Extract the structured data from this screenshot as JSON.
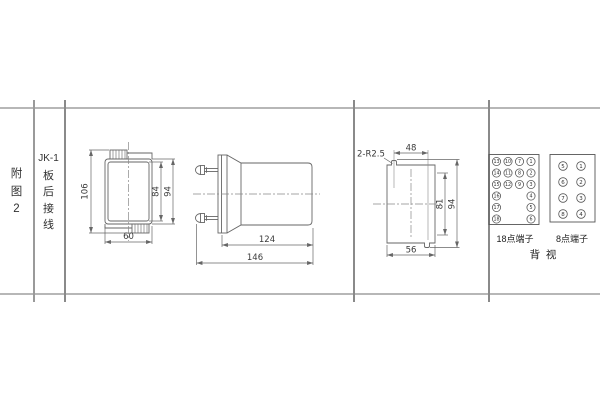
{
  "colors": {
    "background": "#ffffff",
    "drawing_line": "#666666",
    "table_rule_horizontal": "#b7b7b7",
    "table_rule_vertical": "#8a8a8a",
    "text": "#333333"
  },
  "left_panel": {
    "figure_label": [
      "附",
      "图",
      "2"
    ],
    "model_label": [
      "JK-1",
      "板",
      "后",
      "接",
      "线"
    ]
  },
  "front_view": {
    "dim_total_depth": "106",
    "dim_inner_height": "84",
    "dim_outer_height": "94",
    "dim_width": "60"
  },
  "side_view": {
    "dim_body_length": "124",
    "dim_total_length": "146"
  },
  "cutout_view": {
    "slot_callout": "2-R2.5",
    "dim_slot_spacing": "48",
    "dim_height_inner": "81",
    "dim_height_total": "94",
    "dim_width": "56"
  },
  "terminals": {
    "t18": {
      "label": "18点端子",
      "col1": [
        "13",
        "14",
        "15",
        "16",
        "17",
        "18"
      ],
      "col2": [
        "10",
        "11",
        "12"
      ],
      "col3": [
        "7",
        "8",
        "9"
      ],
      "col4": [
        "1",
        "2",
        "3",
        "4",
        "5",
        "6"
      ]
    },
    "t8": {
      "label": "8点端子",
      "col1": [
        "5",
        "6",
        "7",
        "8"
      ],
      "col2": [
        "1",
        "2",
        "3",
        "4"
      ]
    },
    "view_label": "背  视"
  }
}
